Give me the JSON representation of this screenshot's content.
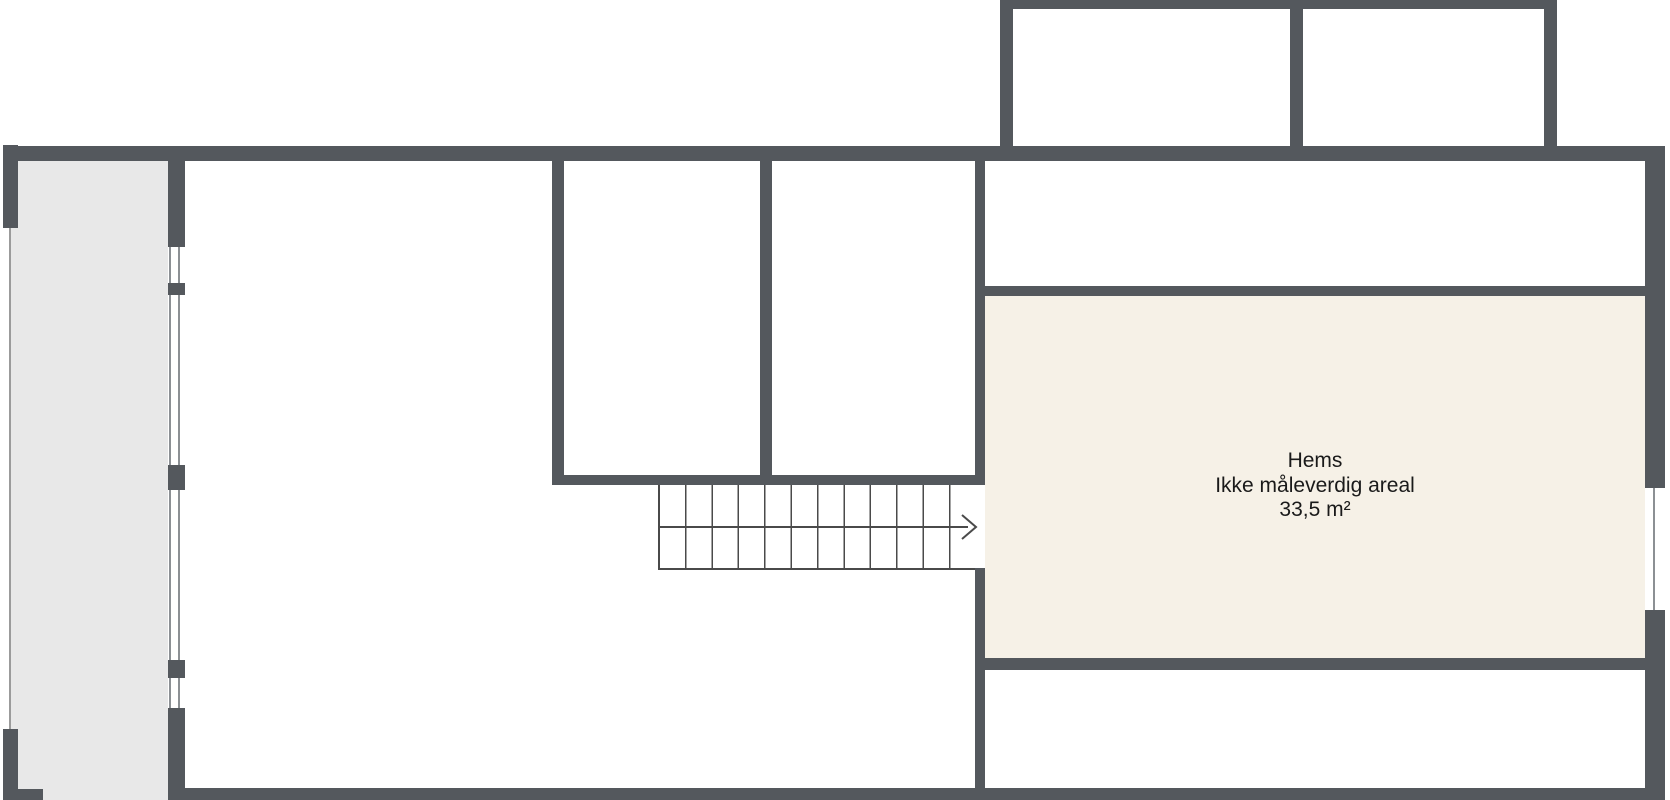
{
  "document": {
    "kind": "floor-plan",
    "language": "no"
  },
  "rooms": {
    "hems": {
      "name": "Hems",
      "note": "Ikke måleverdig areal",
      "area": "33,5 m²"
    }
  },
  "stairs": {
    "direction_icon": "arrow-right",
    "tread_count": 12
  },
  "colors": {
    "wall": "#54585D",
    "hems_fill": "#F6F1E7",
    "balcony_fill": "#E8E8E8",
    "stair_line": "#4A4A4A",
    "label_text": "#1A1A1A"
  }
}
